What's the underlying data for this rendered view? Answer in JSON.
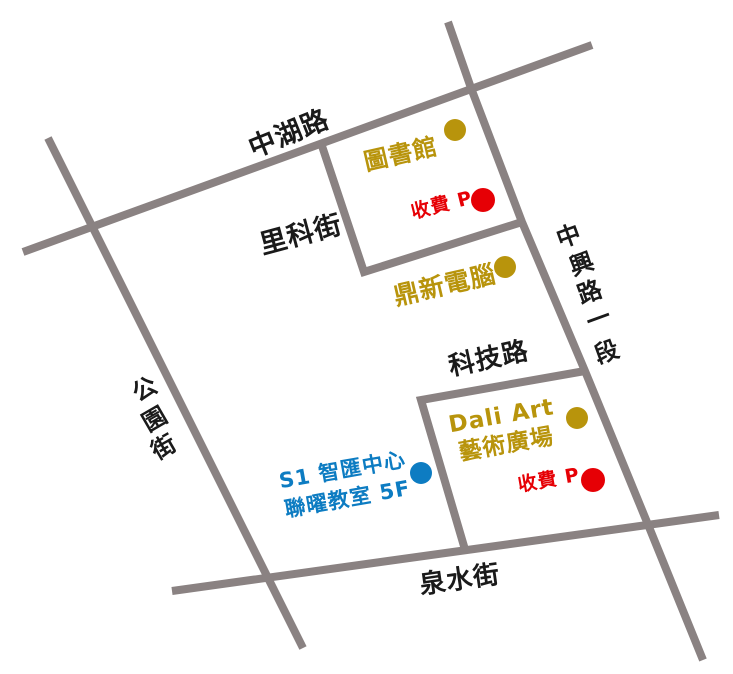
{
  "map": {
    "colors": {
      "road": "#8a8282",
      "road_label": "#1a1a1a",
      "landmark_gold": "#b8940c",
      "parking_red": "#e60005",
      "venue_blue": "#0d7cc2"
    },
    "roads": {
      "zhonghu": {
        "label": "中湖路"
      },
      "like": {
        "label": "里科街"
      },
      "keji": {
        "label": "科技路"
      },
      "quanshui": {
        "label": "泉水街"
      },
      "gongyuan": {
        "label": "公園街",
        "chars": [
          "公",
          "園",
          "街"
        ]
      },
      "zhongxing": {
        "label": "中興路一段",
        "chars": [
          "中",
          "興",
          "路",
          "一",
          "段"
        ]
      }
    },
    "places": {
      "library": {
        "label": "圖書館",
        "marker": "gold-dot"
      },
      "parking_north": {
        "label": "收費 P",
        "marker": "red-dot"
      },
      "dingxin": {
        "label": "鼎新電腦",
        "marker": "gold-dot"
      },
      "dali": {
        "line1": "Dali Art",
        "line2": "藝術廣場",
        "marker": "gold-dot"
      },
      "parking_south": {
        "label": "收費 P",
        "marker": "red-dot"
      },
      "s1": {
        "line1": "S1 智匯中心",
        "line2": "聯曜教室 5F",
        "marker": "blue-dot"
      }
    }
  }
}
